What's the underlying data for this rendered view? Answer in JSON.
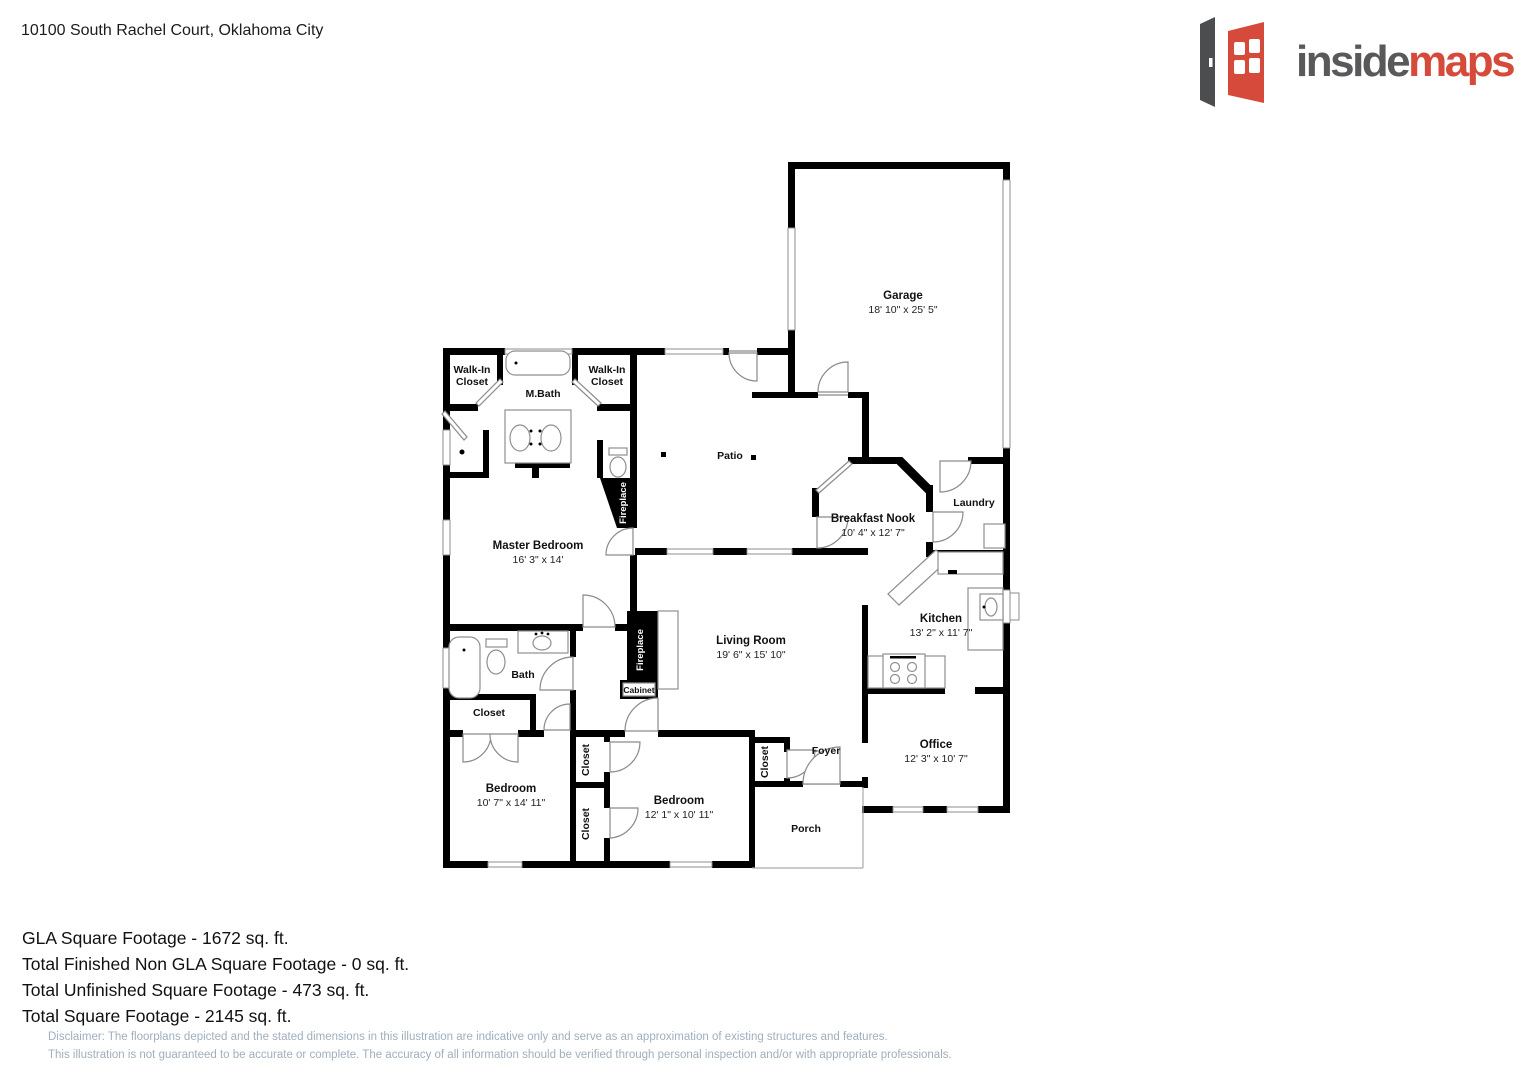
{
  "header": {
    "address": "10100 South Rachel Court, Oklahoma City"
  },
  "logo": {
    "part1": "inside",
    "part2": "maps",
    "accent_color": "#d64a3b",
    "gray_color": "#59595b"
  },
  "rooms": {
    "garage": {
      "label": "Garage",
      "dims": "18' 10\" x 25' 5\""
    },
    "patio": {
      "label": "Patio"
    },
    "walk_in_closet_left": {
      "label_line1": "Walk-In",
      "label_line2": "Closet"
    },
    "walk_in_closet_right": {
      "label_line1": "Walk-In",
      "label_line2": "Closet"
    },
    "m_bath": {
      "label": "M.Bath"
    },
    "master_bedroom": {
      "label": "Master Bedroom",
      "dims": "16' 3\" x 14'"
    },
    "breakfast_nook": {
      "label": "Breakfast Nook",
      "dims": "10' 4\" x 12' 7\""
    },
    "laundry": {
      "label": "Laundry"
    },
    "kitchen": {
      "label": "Kitchen",
      "dims": "13' 2\" x 11' 7\""
    },
    "living_room": {
      "label": "Living Room",
      "dims": "19' 6\" x 15' 10\""
    },
    "fireplace_master": {
      "label": "Fireplace"
    },
    "fireplace_living": {
      "label": "Fireplace"
    },
    "cabinet": {
      "label": "Cabinet"
    },
    "bath": {
      "label": "Bath"
    },
    "closet_hall": {
      "label": "Closet"
    },
    "bedroom_left": {
      "label": "Bedroom",
      "dims": "10' 7\" x 14' 11\""
    },
    "closet_a": {
      "label": "Closet"
    },
    "closet_b": {
      "label": "Closet"
    },
    "bedroom_middle": {
      "label": "Bedroom",
      "dims": "12' 1\" x 10' 11\""
    },
    "closet_foyer": {
      "label": "Closet"
    },
    "foyer": {
      "label": "Foyer"
    },
    "porch": {
      "label": "Porch"
    },
    "office": {
      "label": "Office",
      "dims": "12' 3\" x 10' 7\""
    }
  },
  "footer": {
    "lines": [
      "GLA Square Footage - 1672 sq. ft.",
      "Total Finished Non GLA Square Footage - 0 sq. ft.",
      "Total Unfinished Square Footage - 473 sq. ft.",
      "Total Square Footage - 2145 sq. ft."
    ],
    "disclaimer": [
      "Disclaimer: The floorplans depicted and the stated dimensions in this illustration are indicative only and serve as an approximation of existing structures and features.",
      "This illustration is not guaranteed to be accurate or complete. The accuracy of all information should be verified through personal inspection and/or with appropriate professionals."
    ]
  }
}
